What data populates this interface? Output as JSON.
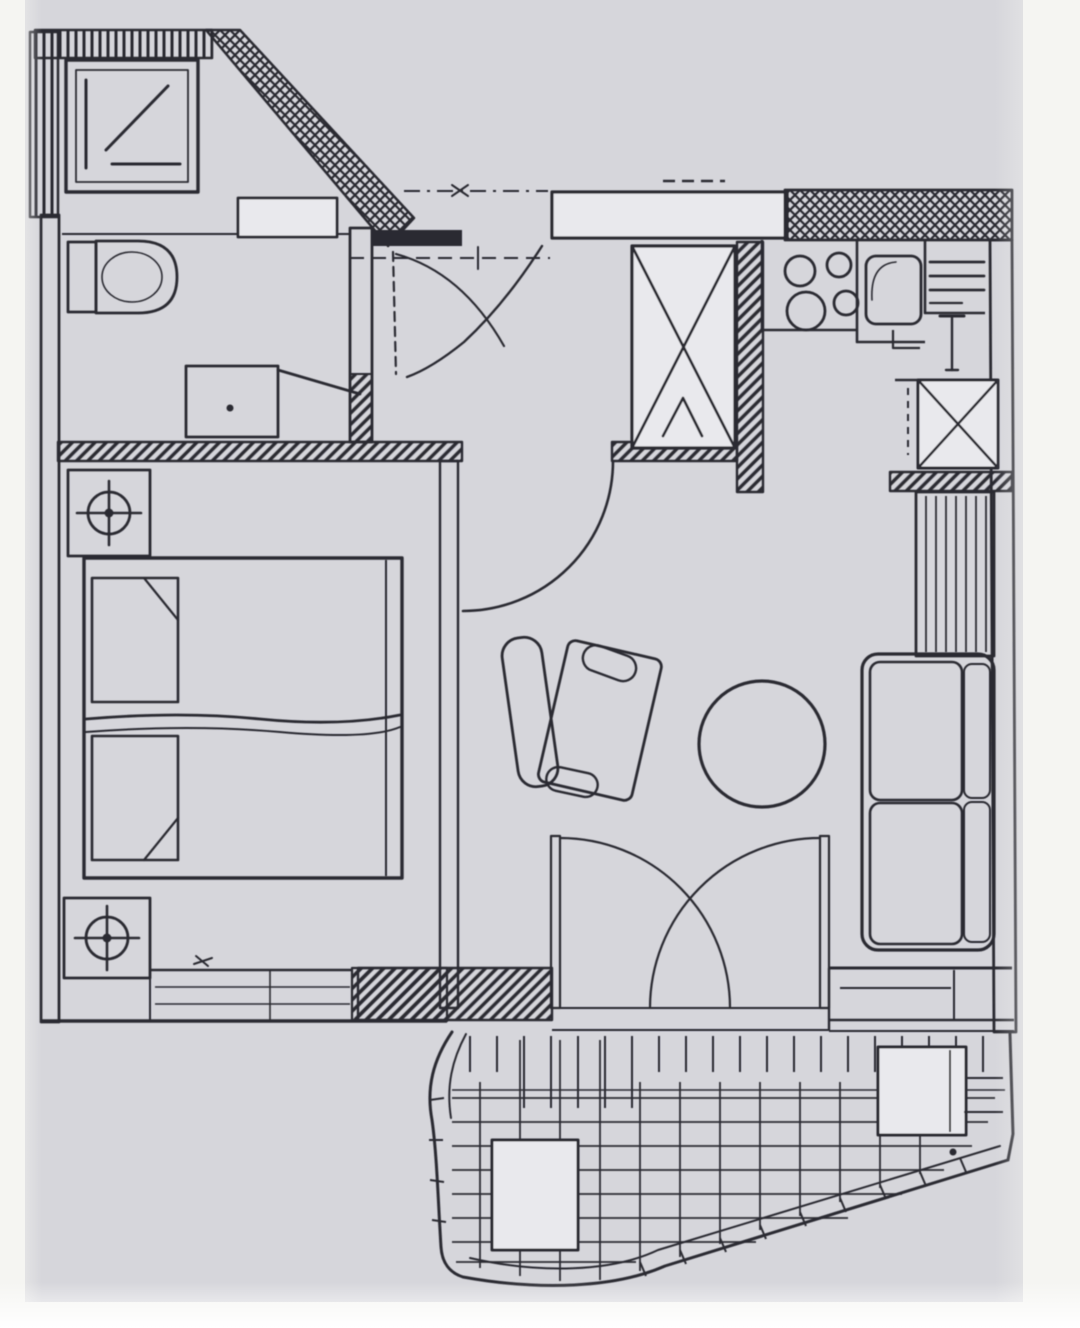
{
  "document": {
    "type": "scanned apartment floor plan",
    "visible_text": []
  },
  "colors": {
    "paper": "#f5f5f2",
    "scan_background": "#d6d6db",
    "ink": "#2b2b33",
    "fixture_fill": "#e9e9ed"
  },
  "rooms": [
    {
      "name": "bathroom",
      "position": "top-left",
      "fixtures": [
        "shower-cabin",
        "toilet",
        "washbasin",
        "cabinet"
      ],
      "features": [
        "sloped-corner-wall",
        "door-to-hall",
        "privacy-screen"
      ]
    },
    {
      "name": "hall",
      "position": "top-center",
      "fixtures": [
        "built-in-wardrobe-x-symbol"
      ],
      "features": [
        "entrance-door-swing",
        "wall-niche",
        "door-to-living-room",
        "dash-dot-section-line",
        "dashed-section-line"
      ]
    },
    {
      "name": "kitchen",
      "position": "top-right",
      "fixtures": [
        "stove-4-burners",
        "kitchen-sink",
        "drainboard",
        "counter",
        "appliance-x-symbol",
        "shelf-unit"
      ]
    },
    {
      "name": "bedroom",
      "position": "left",
      "fixtures": [
        "double-bed",
        "pillow-top",
        "pillow-bottom",
        "nightstand-top",
        "nightstand-bottom",
        "lamp-symbol-top",
        "lamp-symbol-bottom",
        "window-in-bottom-wall"
      ]
    },
    {
      "name": "living-room",
      "position": "center-right",
      "fixtures": [
        "armchair",
        "round-table",
        "two-seat-sofa",
        "double-balcony-door",
        "window-right-bottom-wall"
      ]
    },
    {
      "name": "balcony",
      "position": "bottom",
      "fixtures": [
        "deck-plank-grid",
        "balcony-table-left",
        "balcony-table-right",
        "curved-railing",
        "railing-ticks"
      ]
    }
  ],
  "symbols": {
    "door_swing_arcs": 5,
    "hatched_walls": "load-bearing",
    "cross_hatched_wall": "top-right-exterior",
    "lamp_symbol": "circle-with-cross"
  }
}
